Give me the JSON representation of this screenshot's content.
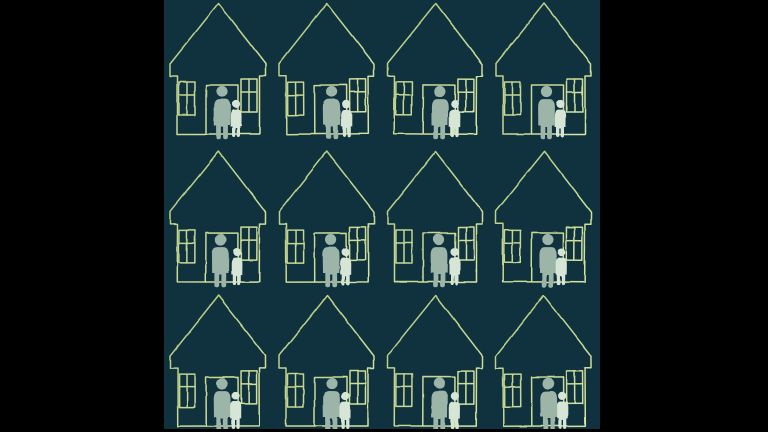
{
  "scene": {
    "description": "Letterboxed square illustration: repeating hand-drawn pattern of house outlines, each with an adult and child silhouette standing at the open doorway",
    "style": "hand-drawn yellow-green line art with pale sage figure silhouettes on dark teal",
    "letterbox": {
      "left_bar_width": 164,
      "right_bar_width": 168,
      "bottom_bar_height": 3,
      "artwork_width": 436,
      "artwork_height": 429
    }
  },
  "colors": {
    "page_background": "#000000",
    "artwork_background": "#0f323e",
    "line_light": "#e6f1b2",
    "line": "#cfe096",
    "line_dark": "#b2c67c",
    "adult_figure": "#9db5a8",
    "child_figure": "#d6e5d5"
  },
  "pattern": {
    "rows": 3,
    "cols": 4,
    "house_width": 97,
    "house_height": 137,
    "col_starts": [
      5.5,
      114,
      222.5,
      331
    ],
    "row_starts": [
      2,
      150,
      294
    ],
    "houses": [
      {
        "row": 0,
        "col": 0,
        "adult_dx": 0,
        "child_dx": 0,
        "tilt": 0
      },
      {
        "row": 0,
        "col": 1,
        "adult_dx": 1,
        "child_dx": 1.5,
        "tilt": -0.3
      },
      {
        "row": 0,
        "col": 2,
        "adult_dx": 1,
        "child_dx": 2,
        "tilt": 0.3
      },
      {
        "row": 0,
        "col": 3,
        "adult_dx": -1,
        "child_dx": -1,
        "tilt": 0
      },
      {
        "row": 1,
        "col": 0,
        "adult_dx": -1.5,
        "child_dx": 1,
        "tilt": 0.2
      },
      {
        "row": 1,
        "col": 1,
        "adult_dx": 0.5,
        "child_dx": 1,
        "tilt": -0.2
      },
      {
        "row": 1,
        "col": 2,
        "adult_dx": 0,
        "child_dx": 1.5,
        "tilt": 0
      },
      {
        "row": 1,
        "col": 3,
        "adult_dx": 0.5,
        "child_dx": 0,
        "tilt": 0.3
      },
      {
        "row": 2,
        "col": 0,
        "adult_dx": 0,
        "child_dx": -0.5,
        "tilt": -0.2
      },
      {
        "row": 2,
        "col": 1,
        "adult_dx": 1,
        "child_dx": 0.5,
        "tilt": 0
      },
      {
        "row": 2,
        "col": 2,
        "adult_dx": 0.5,
        "child_dx": 2,
        "tilt": 0.2
      },
      {
        "row": 2,
        "col": 3,
        "adult_dx": 1,
        "child_dx": 0.5,
        "tilt": -0.3
      }
    ]
  }
}
